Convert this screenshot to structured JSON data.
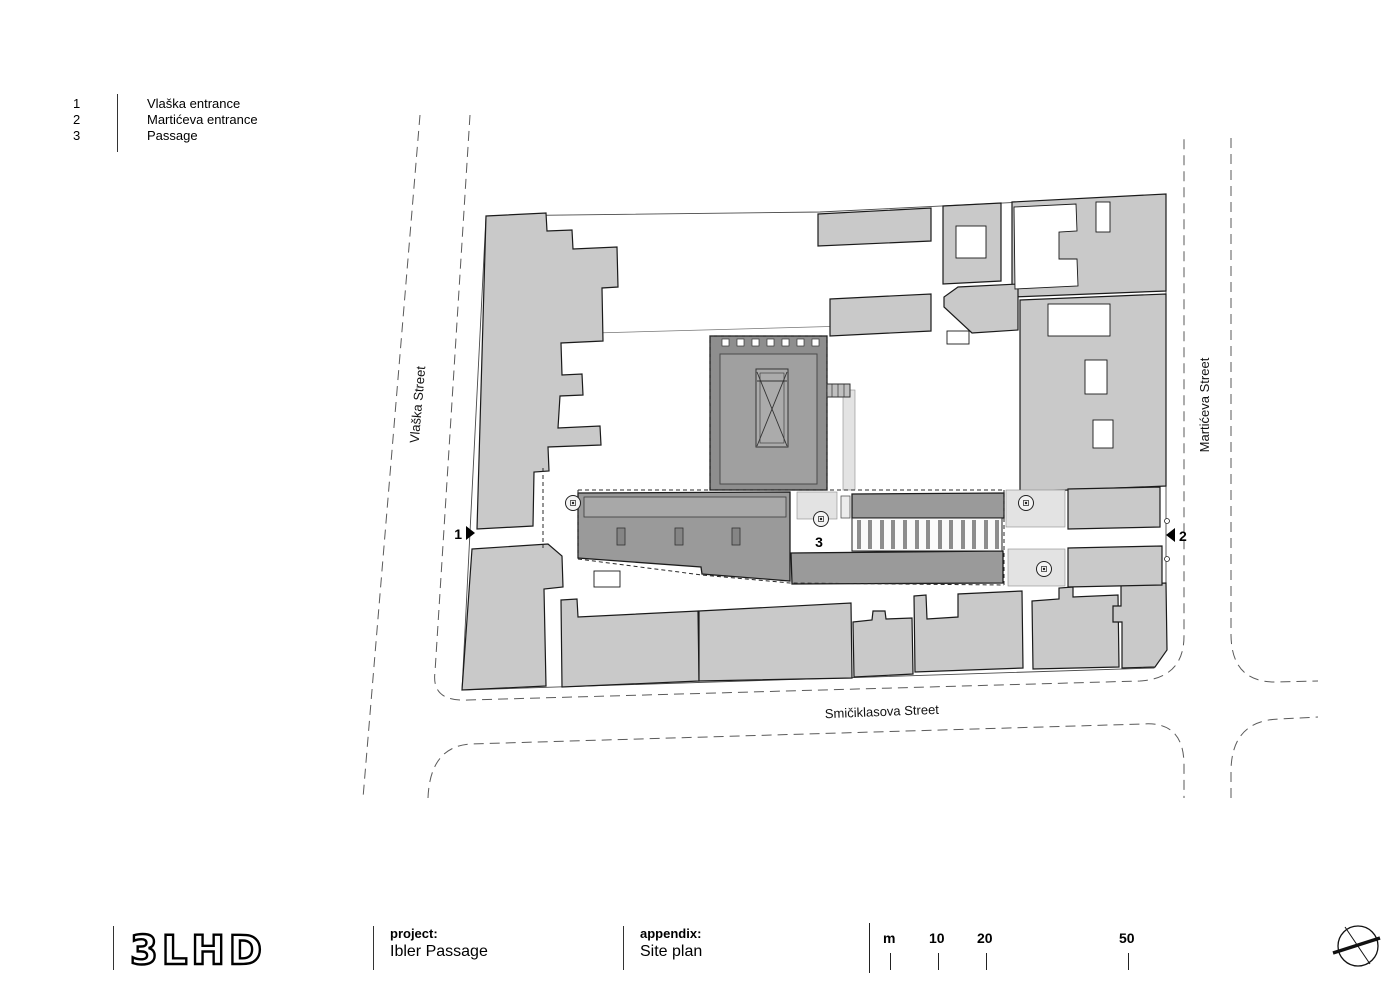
{
  "legend": {
    "items": [
      {
        "number": "1",
        "label": "Vlaška entrance"
      },
      {
        "number": "2",
        "label": "Martićeva entrance"
      },
      {
        "number": "3",
        "label": "Passage"
      }
    ]
  },
  "plan": {
    "streets": {
      "left": "Vlaška Street",
      "right": "Martićeva Street",
      "bottom": "Smičiklasova Street"
    },
    "markers": {
      "entrance1": "1",
      "entrance2": "2",
      "passage": "3"
    }
  },
  "title_block": {
    "logo_text": "3LHD",
    "project_label": "project:",
    "project_value": "Ibler Passage",
    "appendix_label": "appendix:",
    "appendix_value": "Site plan",
    "scale_bar": {
      "unit": "m",
      "ticks": [
        "10",
        "20",
        "50"
      ]
    }
  },
  "colors": {
    "context_building": "#c9c9c9",
    "project_building": "#9a9a9a",
    "hall_roof": "#8e8e8e",
    "courtyard": "#e3e3e3",
    "outline": "#1a1a1a",
    "street_line": "#5a5a5a"
  }
}
